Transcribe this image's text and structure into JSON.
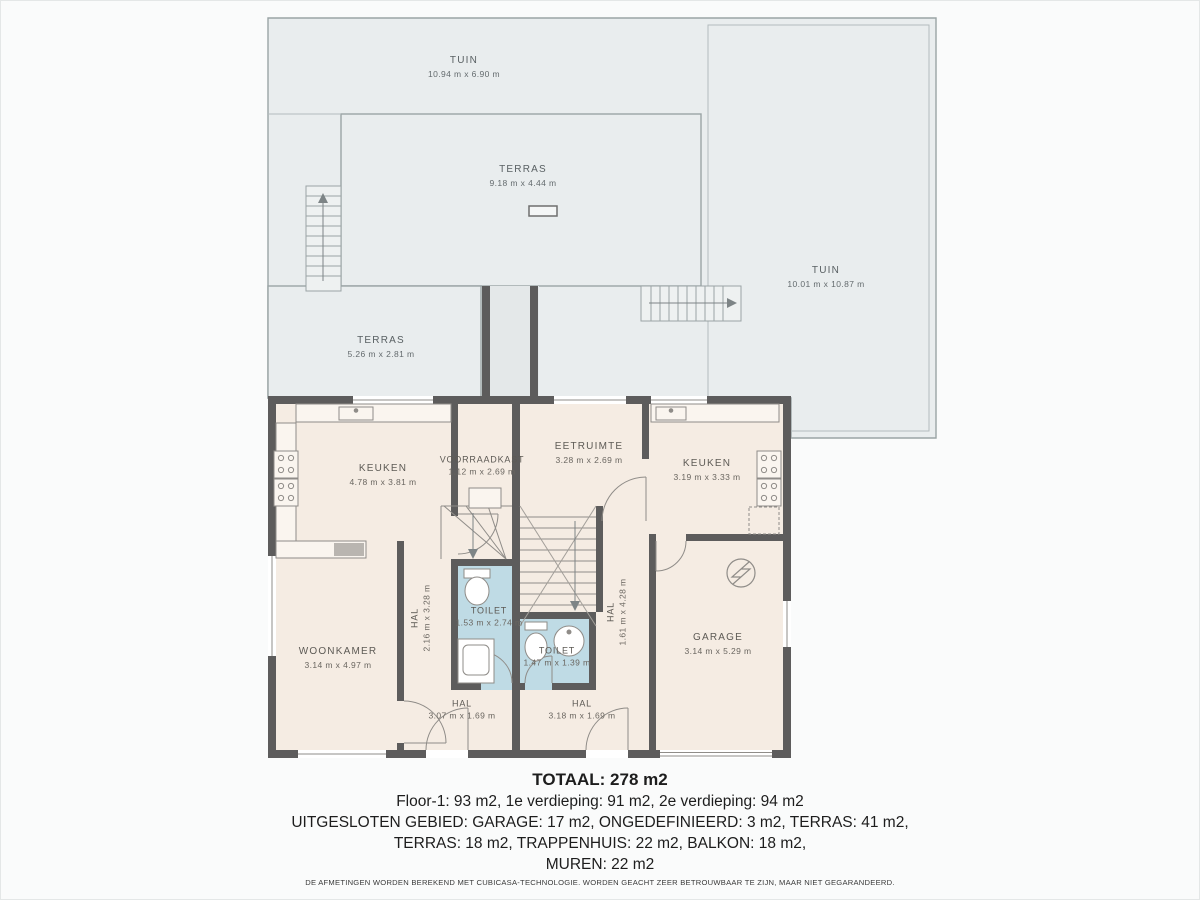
{
  "colors": {
    "page_bg": "#fafbfb",
    "outdoor_fill": "#e9edee",
    "outdoor_line": "#9aa4a5",
    "floor_fill": "#f5ece3",
    "wet_room_fill": "#bfdbe5",
    "wall": "#5d5c5c",
    "fixture_line": "#8f8c88",
    "label_text": "#5d5a55",
    "summary_text": "#1d1d1d"
  },
  "outdoor_areas": [
    {
      "name": "TUIN",
      "dims": "10.94 m x 6.90 m"
    },
    {
      "name": "TERRAS",
      "dims": "9.18 m x 4.44 m"
    },
    {
      "name": "TUIN",
      "dims": "10.01 m x 10.87 m"
    },
    {
      "name": "TERRAS",
      "dims": "5.26 m x 2.81 m"
    }
  ],
  "rooms": [
    {
      "name": "KEUKEN",
      "dims": "4.78 m x 3.81 m"
    },
    {
      "name": "VOORRAADKAST",
      "dims": "1.12 m x 2.69 m"
    },
    {
      "name": "EETRUIMTE",
      "dims": "3.28 m x 2.69 m"
    },
    {
      "name": "KEUKEN",
      "dims": "3.19 m x 3.33 m"
    },
    {
      "name": "WOONKAMER",
      "dims": "3.14 m x 4.97 m"
    },
    {
      "name": "HAL",
      "dims": "2.16 m x 3.28 m"
    },
    {
      "name": "TOILET",
      "dims": "1.53 m x 2.74 m"
    },
    {
      "name": "TOILET",
      "dims": "1.47 m x 1.39 m"
    },
    {
      "name": "HAL",
      "dims": "1.61 m x 4.28 m"
    },
    {
      "name": "GARAGE",
      "dims": "3.14 m x 5.29 m"
    },
    {
      "name": "HAL",
      "dims": "3.07 m x 1.69 m"
    },
    {
      "name": "HAL",
      "dims": "3.18 m x 1.69 m"
    }
  ],
  "summary": {
    "total": "TOTAAL: 278 m2",
    "line1": "Floor-1: 93 m2, 1e verdieping: 91 m2, 2e verdieping: 94 m2",
    "line2": "UITGESLOTEN GEBIED: GARAGE: 17 m2, ONGEDEFINIEERD: 3 m2, TERRAS: 41 m2,",
    "line3": "TERRAS: 18 m2, TRAPPENHUIS: 22 m2, BALKON: 18 m2,",
    "line4": "MUREN: 22 m2"
  },
  "disclaimer": "DE AFMETINGEN WORDEN BEREKEND MET CUBICASA-TECHNOLOGIE. WORDEN GEACHT ZEER BETROUWBAAR TE ZIJN, MAAR NIET GEGARANDEERD."
}
